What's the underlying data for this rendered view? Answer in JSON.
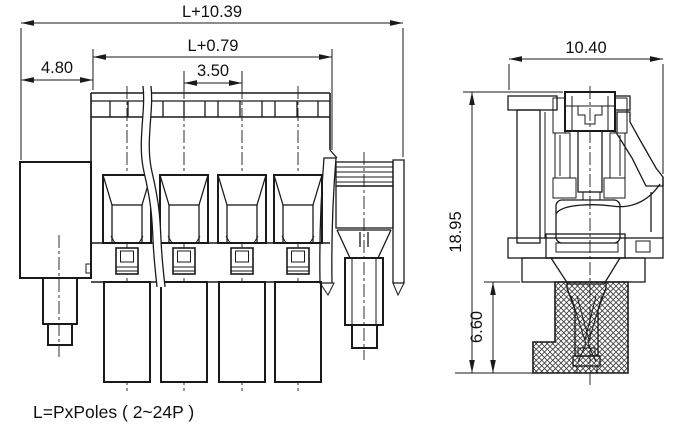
{
  "drawing": {
    "note": "L=PxPoles ( 2~24P )",
    "front_view": {
      "poles_visible": 4,
      "dimensions": {
        "overall_width": "L+10.39",
        "housing_width": "L+0.79",
        "flange_width": "4.80",
        "pole_pitch": "3.50"
      }
    },
    "side_view": {
      "dimensions": {
        "overall_depth": "10.40",
        "overall_height": "18.95",
        "lower_height": "6.60"
      }
    },
    "colors": {
      "line": "#1a1a1a",
      "background": "#ffffff"
    }
  }
}
